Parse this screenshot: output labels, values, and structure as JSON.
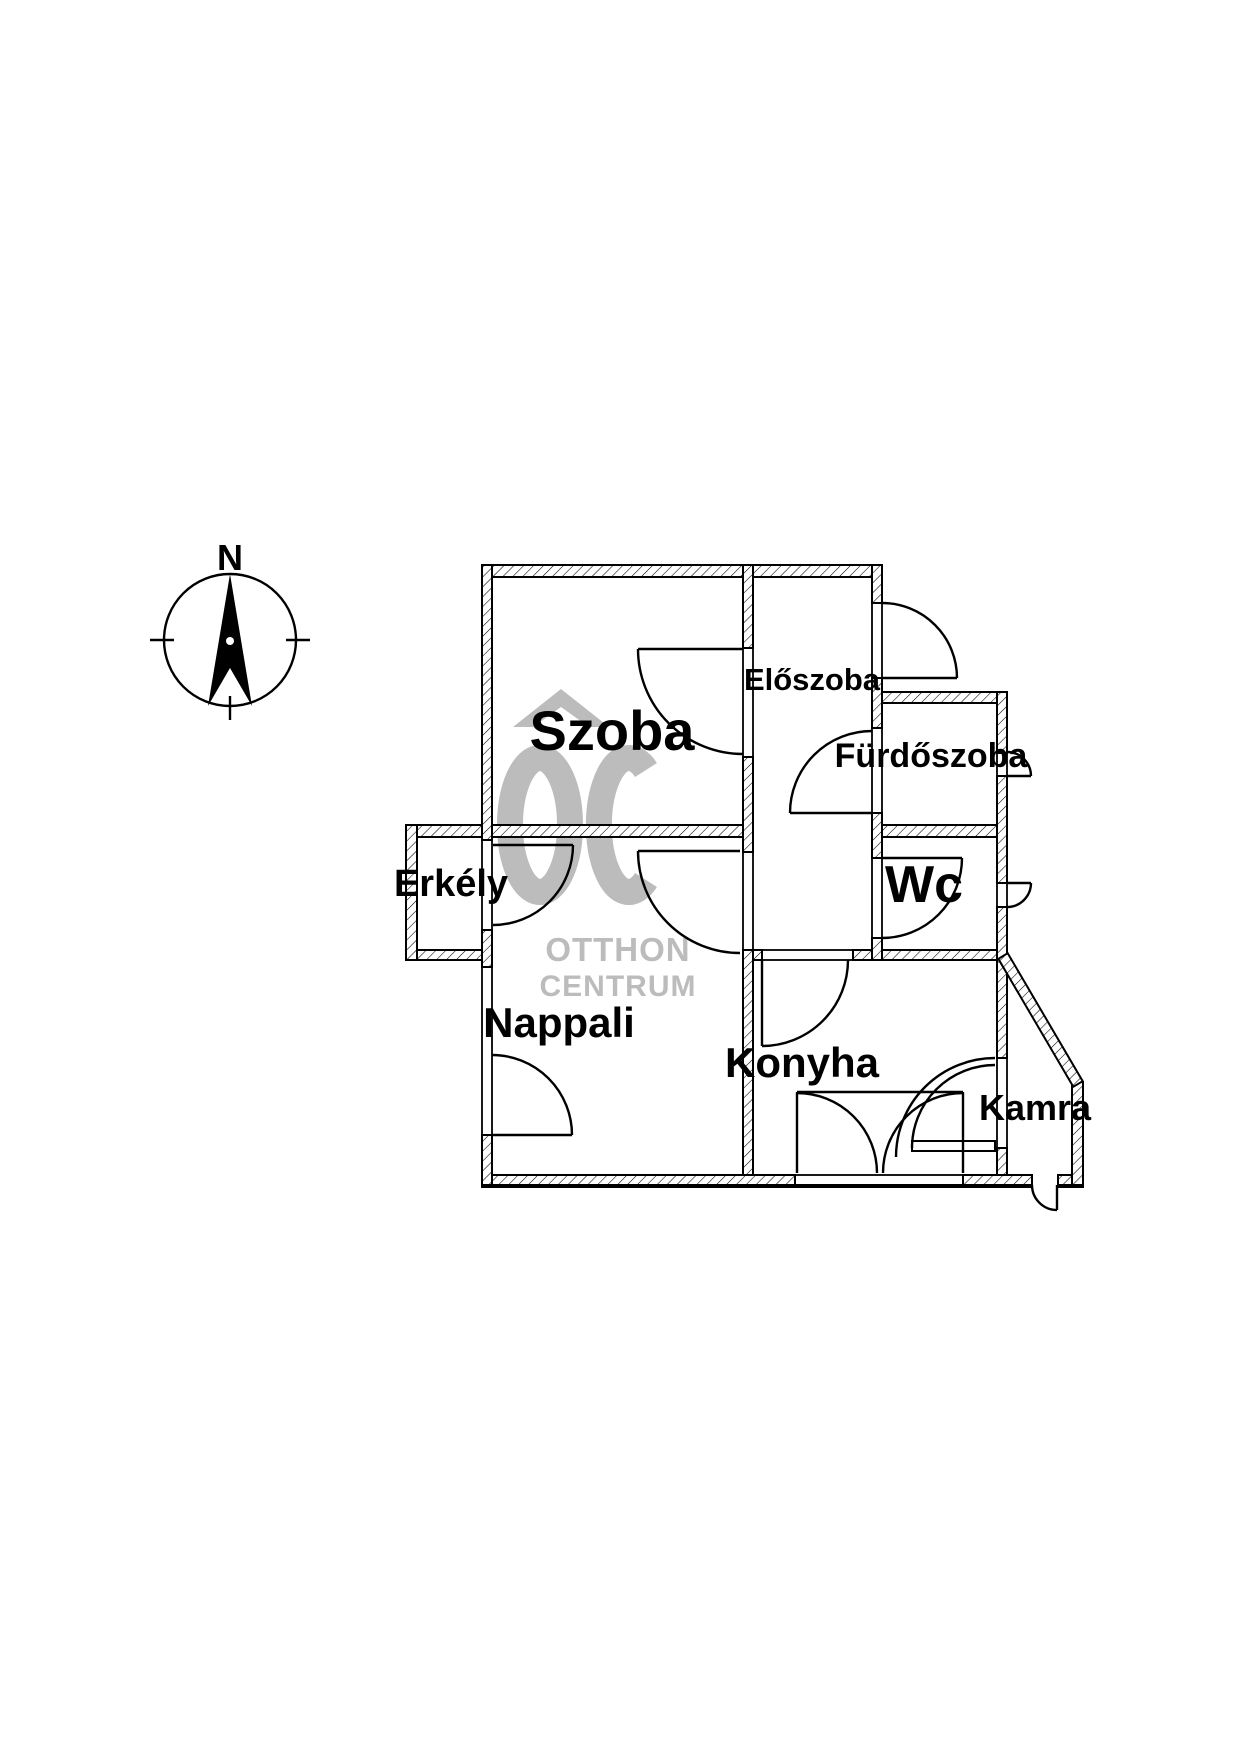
{
  "page": {
    "background": "#ffffff",
    "type_note": "apartment floor plan drawing"
  },
  "colors": {
    "ink": "#000000",
    "watermark": "#bcbcbc"
  },
  "compass": {
    "north_label": "N"
  },
  "watermark": {
    "monogram": "OC",
    "line1": "OTTHON",
    "line2": "CENTRUM"
  },
  "rooms": [
    {
      "id": "szoba",
      "name": "Szoba"
    },
    {
      "id": "eloszoba",
      "name": "Előszoba"
    },
    {
      "id": "furdoszoba",
      "name": "Fürdőszoba"
    },
    {
      "id": "wc",
      "name": "Wc"
    },
    {
      "id": "erkely",
      "name": "Erkély"
    },
    {
      "id": "nappali",
      "name": "Nappali"
    },
    {
      "id": "konyha",
      "name": "Konyha"
    },
    {
      "id": "kamra",
      "name": "Kamra"
    }
  ]
}
